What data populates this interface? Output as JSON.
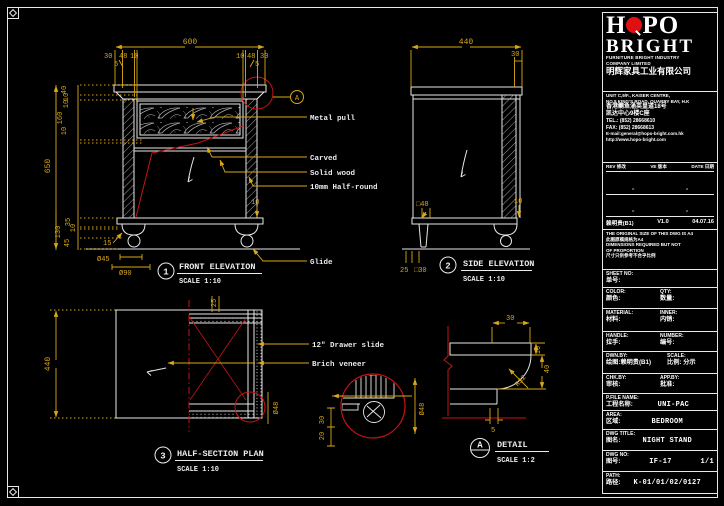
{
  "palette": {
    "background": "#000000",
    "line": "#e8e8e8",
    "dimension": "#d9a818",
    "red": "#c81414",
    "logo_red": "#e01010"
  },
  "front": {
    "bubble": "1",
    "title": "FRONT ELEVATION",
    "scale": "SCALE 1:10",
    "detail_mark": "A",
    "dim_600": "600",
    "dim_30a": "30",
    "dim_48a": "48",
    "dim_10a": "10",
    "dim_10b": "10",
    "dim_48b": "48",
    "dim_30b": "30",
    "dim_5a": "5",
    "dim_5b": "5",
    "dim_40": "40",
    "dim_10c": "10",
    "dim_10d": "10",
    "dim_160": "160",
    "dim_10e": "10",
    "dim_650": "650",
    "dim_35": "35",
    "dim_10f": "10",
    "dim_130": "130",
    "dim_45": "45",
    "dim_15": "15",
    "dim_d45": "Ø45",
    "dim_d90": "Ø90",
    "dim_10g": "10",
    "lbl_metal_pull": "Metal pull",
    "lbl_carved": "Carved",
    "lbl_solid_wood": "Solid wood",
    "lbl_half_round": "10mm Half-round",
    "lbl_glide": "Glide"
  },
  "side": {
    "bubble": "2",
    "title": "SIDE ELEVATION",
    "scale": "SCALE 1:10",
    "dim_440": "440",
    "dim_30": "30",
    "dim_sq48": "□48",
    "dim_10": "10",
    "dim_25": "25",
    "dim_sq30": "□30"
  },
  "plan": {
    "bubble": "3",
    "title": "HALF-SECTION PLAN",
    "scale": "SCALE 1:10",
    "dim_440": "440",
    "dim_25": "25",
    "dim_d48a": "Ø48",
    "dim_d48b": "Ø48",
    "dim_30": "30",
    "dim_20": "20",
    "lbl_slide": "12\" Drawer slide",
    "lbl_veneer": "Brich veneer"
  },
  "detail": {
    "bubble": "A",
    "title": "DETAIL",
    "scale": "SCALE 1:2",
    "dim_30": "30",
    "dim_10": "10",
    "dim_40": "40",
    "dim_r32": "R32",
    "dim_5": "5"
  },
  "titleblock": {
    "logo_h": "H",
    "logo_po": "PO",
    "logo_bright": "BRIGHT",
    "company_en1": "FURNITURE BRIGHT INDUSTRY",
    "company_en2": "COMPANY LIMITED",
    "company_cn": "明辉家具工业有限公司",
    "addr1": "UNIT C,9/F., KAISER CENTRE,",
    "addr2": "NO.8 KING'S ROAD, QUARRY BAY, H.K",
    "addr3": "香港鲗鱼涌英皇道18号",
    "addr4": "凯达中心9楼C座",
    "tel": "TEL.: (852) 28668610",
    "fax": "FAX: (852) 28668613",
    "email": "E-mail:general@hopo-bright.com.hk",
    "web": "http://www.hopo-bright.com",
    "rev": {
      "h_rev": "REV 修改",
      "h_ve": "VE 版本",
      "h_date": "DATE 日期",
      "caret": "^",
      "row_rev": "赖明贵(B1)",
      "row_ve": "V1.0",
      "row_date": "04.07.16"
    },
    "notes": [
      "THE ORIGINAL SIZE OF THIS DWG IS A4",
      "此图原稿规格为A4",
      "DIMENSIONS REQUIRED BUT NOT",
      "OF PROPORTION",
      "尺寸只供参考不合乎比例"
    ],
    "fields": {
      "sheet_en": "SHEET NO:",
      "sheet_cn": "单号:",
      "color_en": "COLOR:",
      "color_cn": "颜色:",
      "qty_en": "QTY:",
      "qty_cn": "数量:",
      "material_en": "MATERIAL:",
      "material_cn": "材料:",
      "inner_en": "INNER:",
      "inner_cn": "内销:",
      "handle_en": "HANDLE:",
      "handle_cn": "拉手:",
      "number_en": "NUMBER:",
      "number_cn": "编号:",
      "dwn_en": "DWN.BY:",
      "dwn_cn": "绘图:",
      "dwn_val": "赖明贵(B1)",
      "scale_en": "SCALE:",
      "scale_cn": "比例:",
      "scale_val": "分示",
      "chk_en": "CHK.BY:",
      "chk_cn": "审核:",
      "app_en": "APP.BY:",
      "app_cn": "批准:",
      "pfile_en": "P.FILE NAME:",
      "pfile_cn": "工程名称:",
      "pfile_val": "UNI-PAC",
      "area_en": "AREA:",
      "area_cn": "区域:",
      "area_val": "BEDROOM",
      "dwgtitle_en": "DWG TITLE:",
      "dwgtitle_cn": "图名:",
      "dwgtitle_val": "NIGHT STAND",
      "dwgno_en": "DWG NO:",
      "dwgno_cn": "图号:",
      "dwgno_val": "IF-17",
      "dwgno_pages": "1/1",
      "path_en": "PATH:",
      "path_cn": "路径:",
      "path_val": "K-01/01/02/0127"
    }
  }
}
